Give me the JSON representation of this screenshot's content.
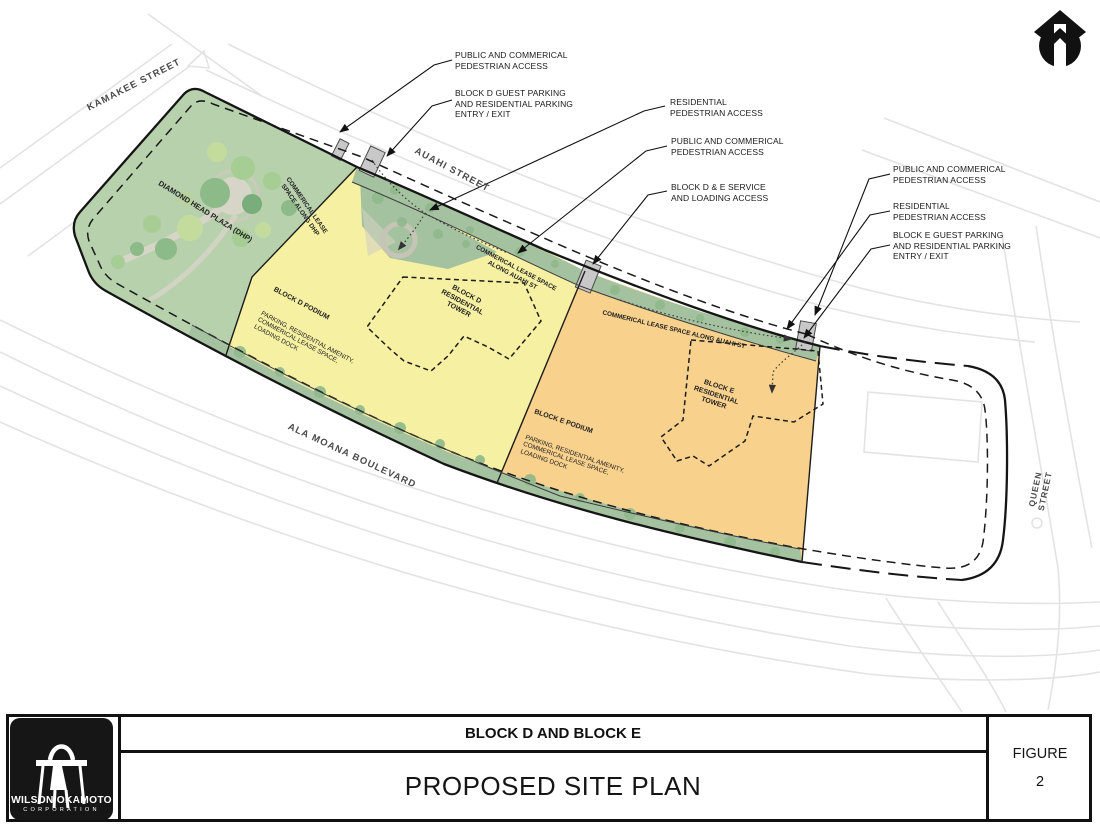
{
  "title_block": {
    "title_line1": "BLOCK D AND BLOCK E",
    "title_line2": "PROPOSED SITE PLAN",
    "figure_label": "FIGURE",
    "figure_number": "2"
  },
  "logo": {
    "company": "WILSON OKAMOTO",
    "division": "CORPORATION"
  },
  "map": {
    "streets": {
      "kamakee": "KAMAKEE STREET",
      "auahi": "AUAHI STREET",
      "ala_moana": "ALA MOANA BOULEVARD",
      "queen": "QUEEN STREET"
    },
    "areas": {
      "plaza": "DIAMOND HEAD PLAZA (DHP)",
      "lease_dhp": "COMMERICAL LEASE\nSPACE ALONG DHP",
      "lease_auahi_d": "COMMERICAL LEASE SPACE\nALONG AUAHI ST",
      "lease_auahi_e": "COMMERICAL LEASE SPACE  ALONG AUAHI ST",
      "block_d_tower": "BLOCK D\nRESIDENTIAL\nTOWER",
      "block_e_tower": "BLOCK E\nRESIDENTIAL\nTOWER",
      "block_d_podium": {
        "title": "BLOCK D PODIUM",
        "desc": "PARKING, RESIDENTIAL AMENITY,\nCOMMERICAL LEASE SPACE,\nLOADING DOCK"
      },
      "block_e_podium": {
        "title": "BLOCK E PODIUM",
        "desc": "PARKING, RESIDENTIAL AMENITY,\nCOMMERICAL LEASE SPACE,\nLOADING DOCK"
      }
    },
    "callouts": [
      {
        "text": "PUBLIC AND COMMERICAL\nPEDESTRIAN ACCESS"
      },
      {
        "text": "BLOCK D GUEST PARKING\nAND RESIDENTIAL PARKING\nENTRY / EXIT"
      },
      {
        "text": "RESIDENTIAL\nPEDESTRIAN ACCESS"
      },
      {
        "text": "PUBLIC AND COMMERICAL\nPEDESTRIAN ACCESS"
      },
      {
        "text": "BLOCK D & E SERVICE\nAND LOADING ACCESS"
      },
      {
        "text": "PUBLIC AND COMMERICAL\nPEDESTRIAN ACCESS"
      },
      {
        "text": "RESIDENTIAL\nPEDESTRIAN ACCESS"
      },
      {
        "text": "BLOCK E GUEST PARKING\nAND RESIDENTIAL PARKING\nENTRY / EXIT"
      }
    ],
    "colors": {
      "block_d_fill": "#f6f0a2",
      "block_e_fill": "#f8d18c",
      "landscape_strip": "#a5c2a0",
      "park_fill": "#b7d1ad",
      "driveway_gray": "#c8c8c8",
      "line_black": "#151515"
    }
  }
}
